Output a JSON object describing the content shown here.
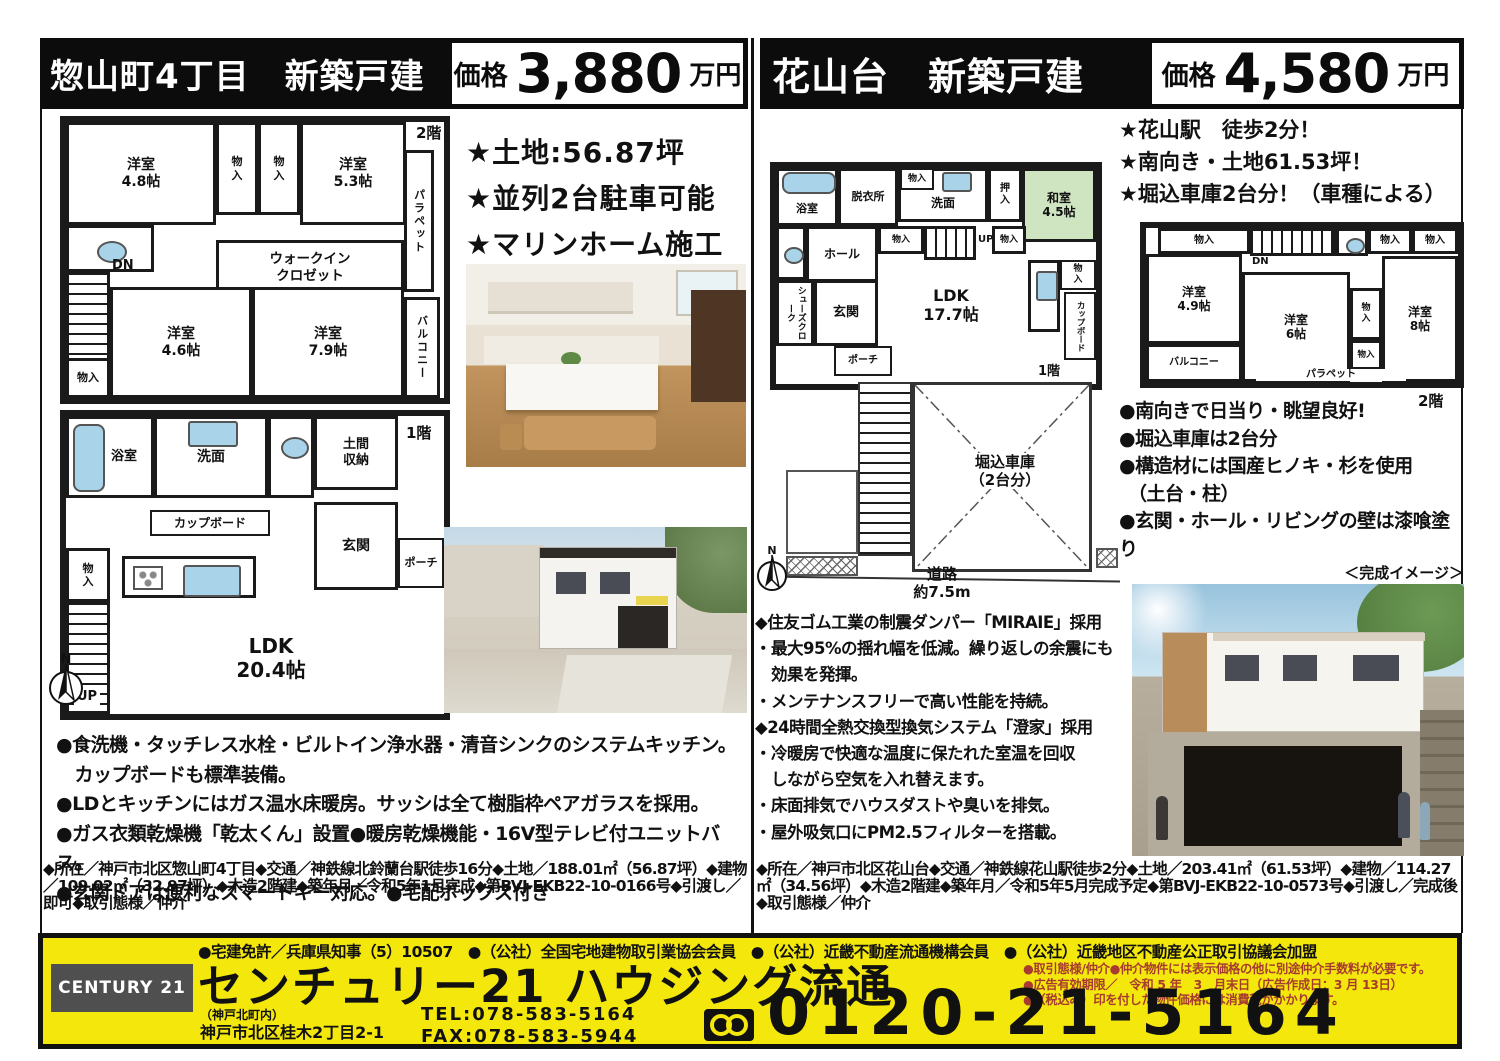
{
  "compass": {
    "n": "N"
  },
  "colors": {
    "header_bg": "#0c0c0c",
    "footer_yellow": "#f3e70c",
    "note_red": "#a73b30",
    "tatami_green": "#cfe5c2",
    "fixture_blue": "#a8d3e8",
    "century_gray": "#4f4f4f"
  },
  "left": {
    "title": "惣山町4丁目　新築戸建",
    "price_label": "価格",
    "price_value": "3,880",
    "price_unit": "万円",
    "features": [
      "★土地:56.87坪",
      "★並列2台駐車可能",
      "★マリンホーム施工"
    ],
    "floor2": {
      "floor_label": "2階",
      "rooms": {
        "y48": "洋室\n4.8帖",
        "c1": "物\n入",
        "c2": "物\n入",
        "y53": "洋室\n5.3帖",
        "parapet": "パラペット",
        "wic": "ウォークイン\nクロゼット",
        "dn": "DN",
        "y46": "洋室\n4.6帖",
        "y79": "洋室\n7.9帖",
        "balcony": "バルコニー",
        "c3": "物入"
      }
    },
    "floor1": {
      "floor_label": "1階",
      "rooms": {
        "bath": "浴室",
        "senmen": "洗面",
        "doma": "土間\n収納",
        "cup": "カップボード",
        "genkan": "玄関",
        "porch": "ポーチ",
        "c4": "物\n入",
        "ldk": "LDK\n20.4帖",
        "up": "UP"
      }
    },
    "bullets": [
      "●食洗機・タッチレス水栓・ビルトイン浄水器・清音シンクのシステムキッチン。",
      "　カップボードも標準装備。",
      "●LDとキッチンにはガス温水床暖房。サッシは全て樹脂枠ペアガラスを採用。",
      "●ガス衣類乾燥機「乾太くん」設置●暖房乾燥機能・16V型テレビ付ユニットバス。",
      "●玄関ドアは便利なスマートキー対応。●宅配ボックス付き"
    ],
    "details": "◆所在／神戸市北区惣山町4丁目◆交通／神鉄線北鈴蘭台駅徒歩16分◆土地／188.01㎡（56.87坪）◆建物／109.02㎡（32.97坪）◆木造2階建◆築年月／令和5年1月完成◆第BVJ-EKB22-10-0166号◆引渡し／即可◆取引態様／仲介"
  },
  "right": {
    "title": "花山台　新築戸建",
    "price_label": "価格",
    "price_value": "4,580",
    "price_unit": "万円",
    "features": [
      "★花山駅　徒歩2分！",
      "★南向き・土地61.53坪！",
      "★堀込車庫2台分！（車種による）"
    ],
    "floor1": {
      "floor_label": "1階",
      "rooms": {
        "bath": "浴室",
        "datsui": "脱衣所",
        "c1": "物入",
        "senmen": "洗面",
        "oshiire": "押\n入",
        "washitsu": "和室\n4.5帖",
        "hall": "ホール",
        "c2": "物入",
        "up": "UP",
        "c3": "物入",
        "shoes": "シューズクローク",
        "genkan": "玄関",
        "porch": "ポーチ",
        "ldk": "LDK\n17.7帖",
        "c5": "物\n入",
        "cup": "カップボード"
      }
    },
    "floor2": {
      "floor_label": "2階",
      "rooms": {
        "c1": "物入",
        "dn": "DN",
        "c2": "物入",
        "c3": "物入",
        "y49": "洋室\n4.9帖",
        "y6": "洋室\n6帖",
        "cm": "物\n入",
        "y8": "洋室\n8帖",
        "balcony": "バルコニー",
        "cn": "物入",
        "parapet": "パラペット"
      }
    },
    "bullets": [
      "●南向きで日当り・眺望良好!",
      "●堀込車庫は2台分",
      "●構造材には国産ヒノキ・杉を使用",
      "　（土台・柱）",
      "●玄関・ホール・リビングの壁は漆喰塗り"
    ],
    "garage_label": "堀込車庫\n（2台分）",
    "road_label": "道路\n約7.5m",
    "diamonds": [
      "◆住友ゴム工業の制震ダンパー「MIRAIE」採用",
      "・最大95%の揺れ幅を低減。繰り返しの余震にも",
      "　効果を発揮。",
      "・メンテナンスフリーで高い性能を持続。",
      "◆24時間全熱交換型換気システム「澄家」採用",
      "・冷暖房で快適な温度に保たれた室温を回収",
      "　しながら空気を入れ替えます。",
      "・床面排気でハウスダストや臭いを排気。",
      "・屋外吸気口にPM2.5フィルターを搭載。"
    ],
    "render_label": "＜完成イメージ＞",
    "details": "◆所在／神戸市北区花山台◆交通／神鉄線花山駅徒歩2分◆土地／203.41㎡（61.53坪）◆建物／114.27㎡（34.56坪）◆木造2階建◆築年月／令和5年5月完成予定◆第BVJ-EKB22-10-0573号◆引渡し／完成後◆取引態様／仲介"
  },
  "footer": {
    "memberships": "●宅建免許／兵庫県知事（5）10507　●（公社）全国宅地建物取引業協会会員　●（公社）近畿不動産流通機構会員　●（公社）近畿地区不動産公正取引協議会加盟",
    "brand": "CENTURY 21",
    "company": "センチュリー21 ハウジング流通",
    "branch": "（神戸北町内）",
    "address": "神戸市北区桂木2丁目2-1",
    "tel": "TEL:078-583-5164",
    "fax": "FAX:078-583-5944",
    "notes": [
      "●取引態様/仲介●仲介物件には表示価格の他に別途仲介手数料が必要です。",
      "●広告有効期限／　令和 5 年　3　月末日（広告作成日：3 月 13日）",
      "●（税込み）印を付した物件価格には消費税がかかります。"
    ],
    "freedial": "0120-21-5164"
  }
}
